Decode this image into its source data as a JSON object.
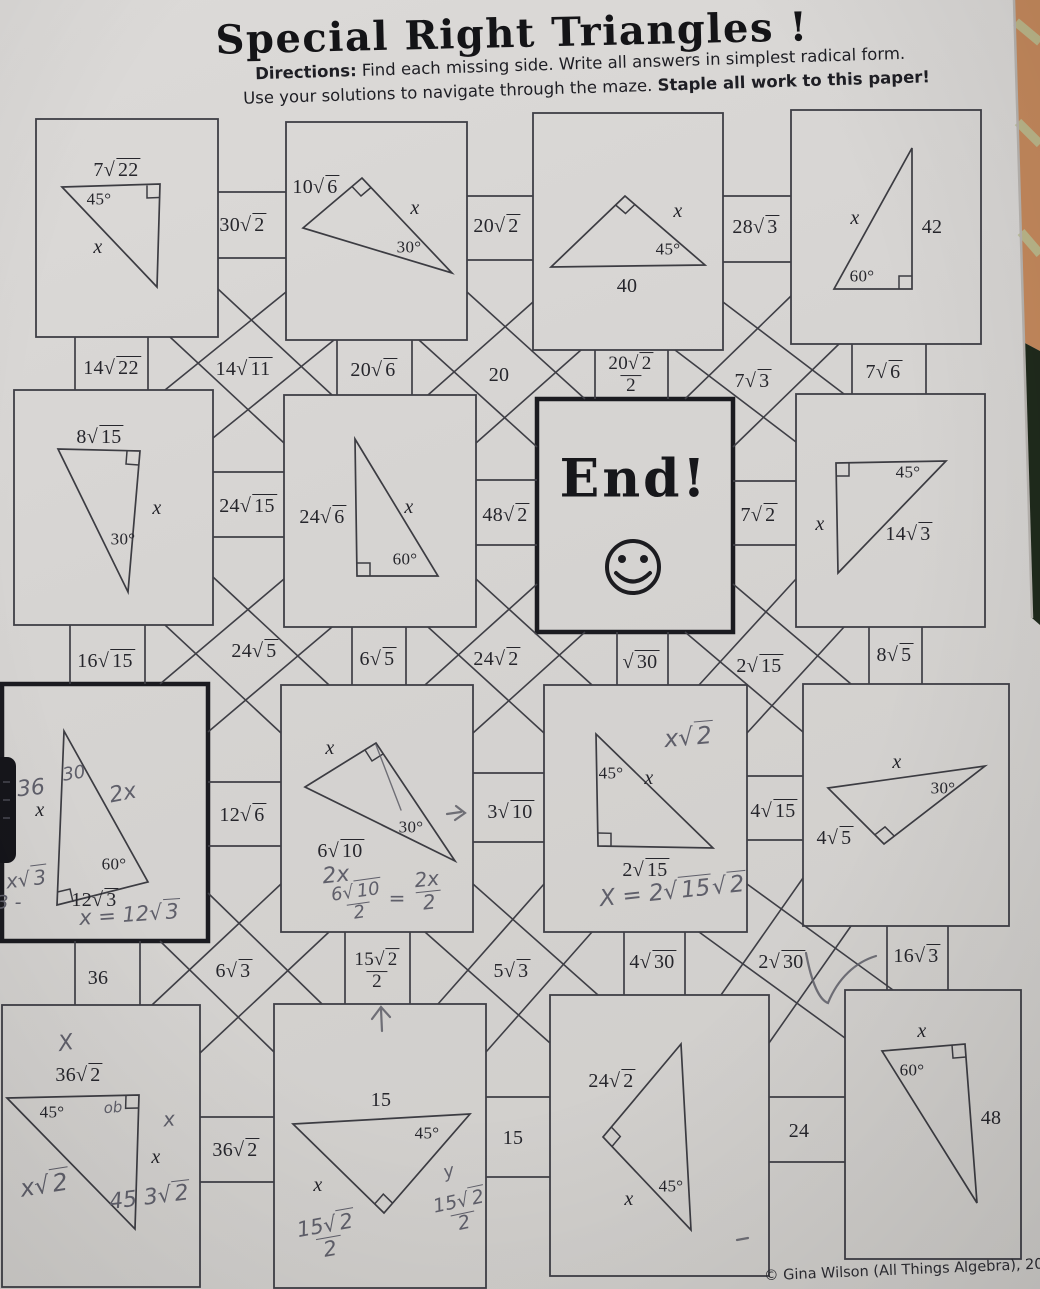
{
  "header": {
    "title": "Special Right Triangles !",
    "directions_label": "Directions:",
    "directions_rest": "Find each missing side.  Write all answers in simplest radical form.",
    "directions2": "Use your solutions to navigate through the maze.  ",
    "directions2_bold": "Staple all work to this paper!"
  },
  "footer": {
    "credit": "© Gina Wilson (All Things Algebra), 2016"
  },
  "end_box": {
    "title": "End!"
  },
  "boxes": {
    "b1": {
      "hyp": "7√22",
      "angle": "45°",
      "x": "x"
    },
    "b2": {
      "side": "10√6",
      "x": "x",
      "angle": "30°"
    },
    "b3": {
      "x": "x",
      "angle": "45°",
      "base": "40"
    },
    "b4": {
      "x": "x",
      "side": "42",
      "angle": "60°"
    },
    "b5": {
      "top": "8√15",
      "x": "x",
      "angle": "30°"
    },
    "b6": {
      "side": "24√6",
      "x": "x",
      "angle": "60°"
    },
    "b8": {
      "angle": "45°",
      "x": "x",
      "hyp": "14√3"
    },
    "b9": {
      "angle": "60°",
      "base": "12√3",
      "x": "x",
      "hw_36": "36",
      "hw_30": "30",
      "hw_2x": "2x",
      "hw_xr3": "x√3",
      "hw_3": "3 -",
      "hw_ans": "x = 12√3"
    },
    "b10": {
      "x": "x",
      "angle": "30°",
      "base": "6√10",
      "hw_2x": "2x",
      "hw_num": "6√10",
      "hw_den": "2",
      "hw_eq": "=",
      "hw_num2": "2x",
      "hw_den2": "2"
    },
    "b11": {
      "angle": "45°",
      "x": "x",
      "base": "2√15",
      "hw_top": "x√2",
      "hw_ans": "X = 2√15√2"
    },
    "b12": {
      "x": "x",
      "angle": "30°",
      "side": "4√5"
    },
    "b13": {
      "top": "36√2",
      "angle": "45°",
      "x": "x",
      "hw_X": "X",
      "hw_ob": "ob",
      "hw_x": "x",
      "hw_xr2": "x√2",
      "hw_ans": "45 3√2"
    },
    "b14": {
      "top": "15",
      "angle": "45°",
      "x": "x",
      "hw_num": "15√2",
      "hw_den": "2",
      "hw_y": "y",
      "hw_num2": "15√2",
      "hw_den2": "2"
    },
    "b15": {
      "side": "24√2",
      "x": "x",
      "angle": "45°"
    },
    "b16": {
      "x": "x",
      "angle": "60°",
      "side": "48"
    }
  },
  "connectors": {
    "c30r2": "30√2",
    "c20r2": "20√2",
    "c28r3": "28√3",
    "c14r22": "14√22",
    "c14r11": "14√11",
    "c20r6": "20√6",
    "c20": "20",
    "c20r2_2n": "20√2",
    "c20r2_2d": "2",
    "c7r3": "7√3",
    "c7r6": "7√6",
    "c24r15": "24√15",
    "c48r2": "48√2",
    "c7r2": "7√2",
    "c16r15": "16√15",
    "c24r5": "24√5",
    "c6r5": "6√5",
    "c24r2": "24√2",
    "cr30": "√30",
    "c2r15": "2√15",
    "c8r5": "8√5",
    "c12r6": "12√6",
    "c3r10": "3√10",
    "c4r15": "4√15",
    "c36": "36",
    "c6r3": "6√3",
    "c15r2_2n": "15√2",
    "c15r2_2d": "2",
    "c5r3": "5√3",
    "c4r30": "4√30",
    "c2r30": "2√30",
    "c16r3": "16√3",
    "c36r2": "36√2",
    "c15": "15",
    "c24": "24"
  }
}
